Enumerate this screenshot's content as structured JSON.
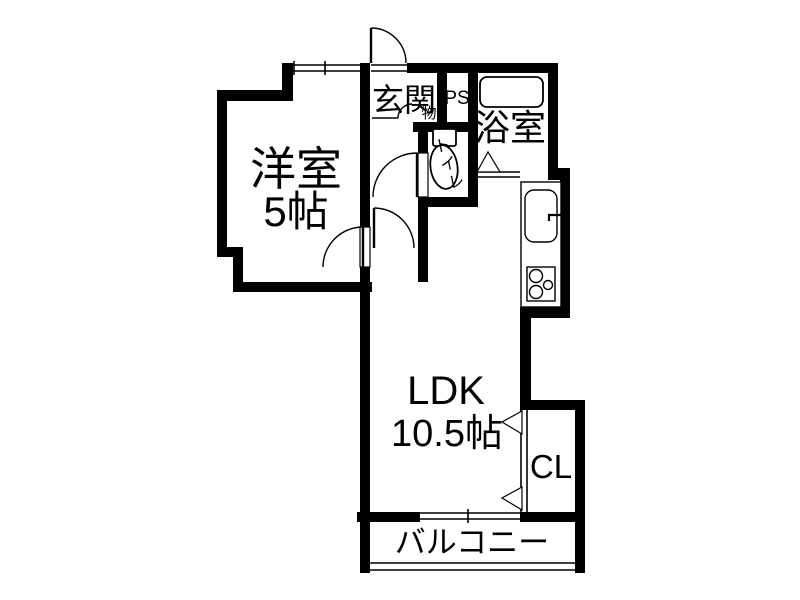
{
  "floorplan": {
    "rooms": {
      "western_room": {
        "label": "洋室",
        "size": "5帖"
      },
      "entrance": {
        "label": "玄関"
      },
      "storage": {
        "label": "物"
      },
      "pipe_shaft": {
        "label": "PS"
      },
      "bathroom": {
        "label": "浴室"
      },
      "toilet": {
        "label": "トイレ",
        "chars": [
          "ト",
          "イ",
          "レ"
        ]
      },
      "ldk": {
        "label": "LDK",
        "size": "10.5帖"
      },
      "closet": {
        "label": "CL"
      },
      "balcony": {
        "label": "バルコニー"
      }
    },
    "colors": {
      "wall": "#000000",
      "background": "#ffffff"
    }
  }
}
